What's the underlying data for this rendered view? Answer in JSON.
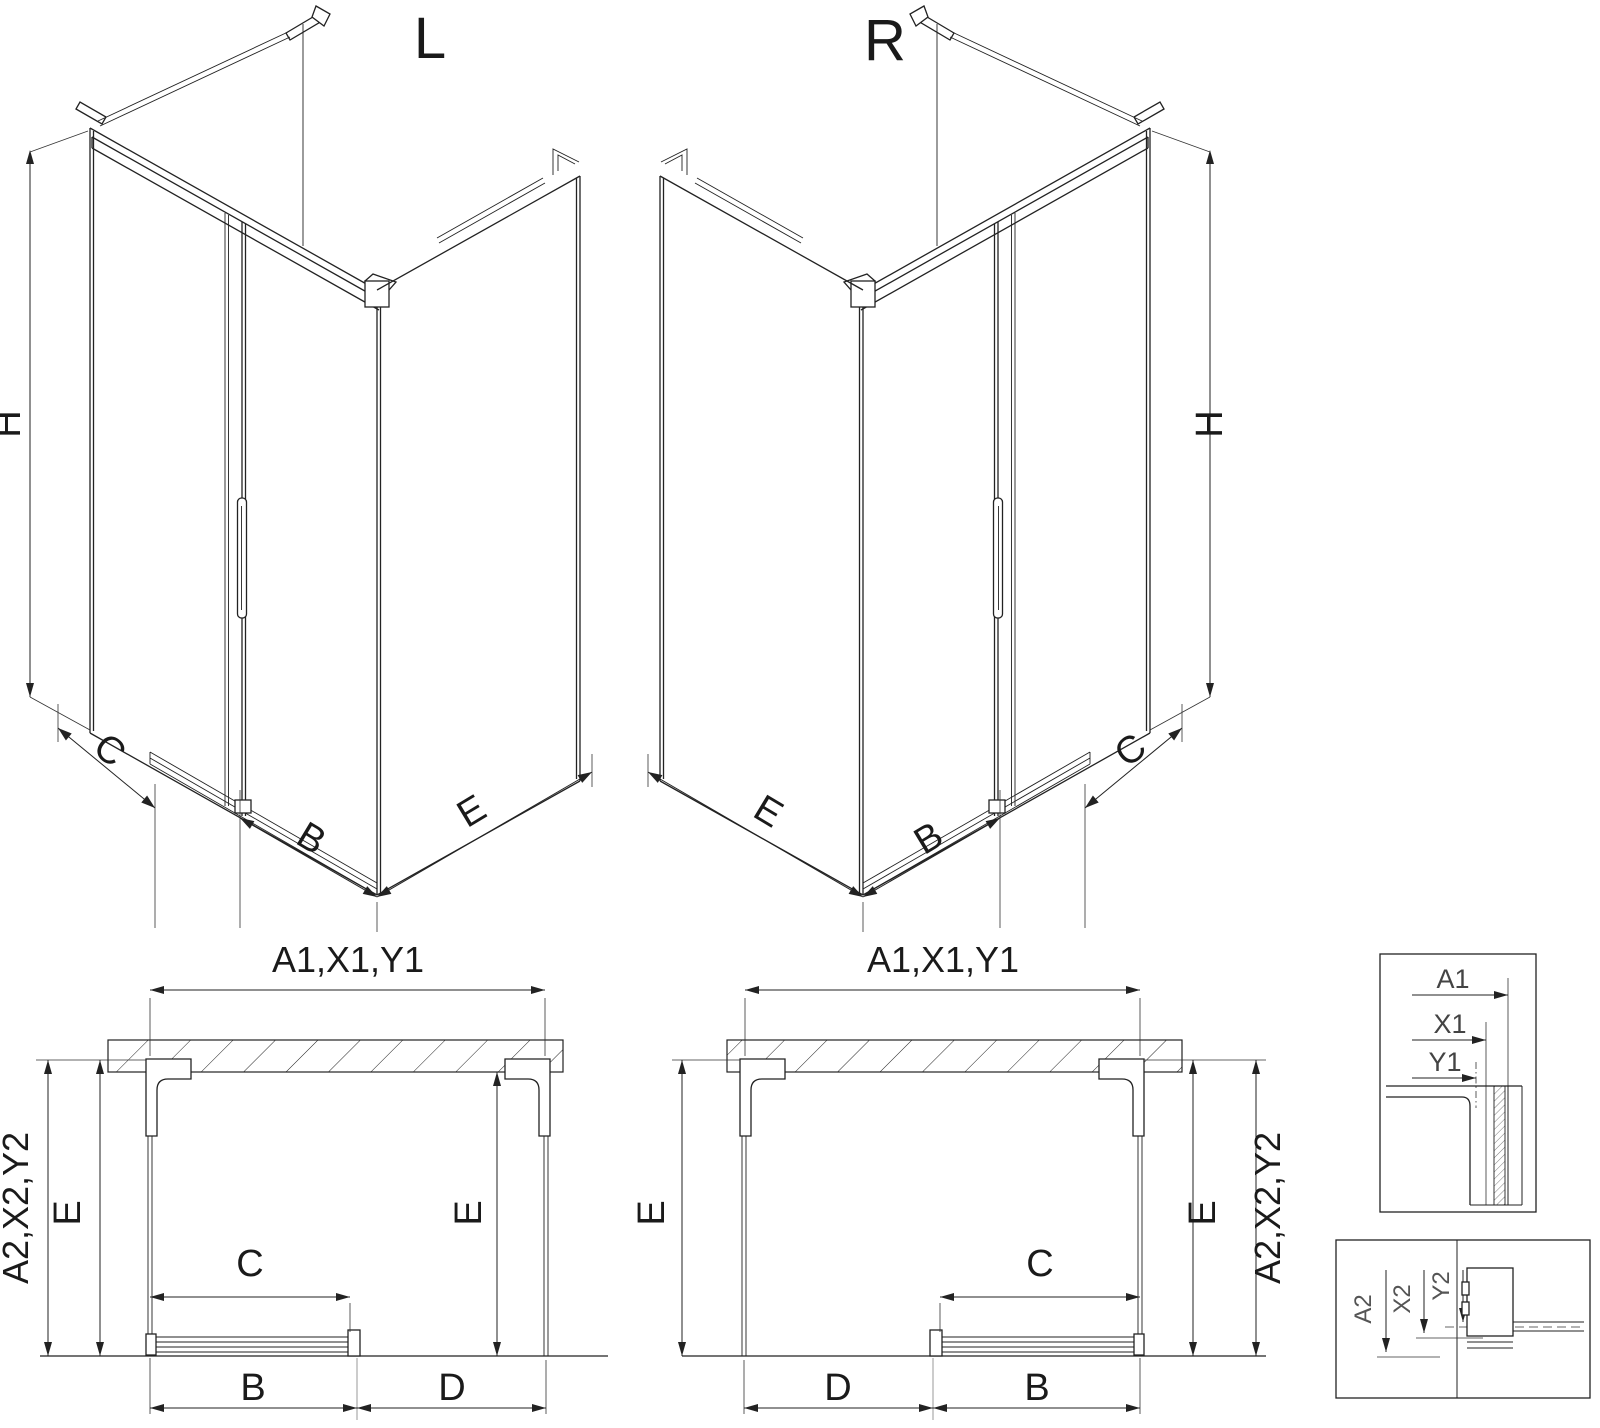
{
  "drawing": {
    "background": "#ffffff",
    "line_color": "#222222",
    "label_color": "#1a1a1a",
    "detail_label_color": "#555555",
    "iso_left": {
      "title": "L",
      "dim_height": "H",
      "dim_fixed": "C",
      "dim_door": "B",
      "dim_side": "E"
    },
    "iso_right": {
      "title": "R",
      "dim_height": "H",
      "dim_fixed": "C",
      "dim_door": "B",
      "dim_side": "E"
    },
    "plan_left": {
      "dim_top": "A1,X1,Y1",
      "dim_side_outer": "A2,X2,Y2",
      "dim_e_left": "E",
      "dim_e_right": "E",
      "dim_opening": "C",
      "dim_door": "B",
      "dim_panel": "D"
    },
    "plan_right": {
      "dim_top": "A1,X1,Y1",
      "dim_side_outer": "A2,X2,Y2",
      "dim_e_left": "E",
      "dim_e_right": "E",
      "dim_opening": "C",
      "dim_door": "B",
      "dim_panel": "D"
    },
    "detail_top": {
      "dim_a": "A1",
      "dim_x": "X1",
      "dim_y": "Y1"
    },
    "detail_bottom": {
      "dim_a": "A2",
      "dim_x": "X2",
      "dim_y": "Y2"
    }
  }
}
